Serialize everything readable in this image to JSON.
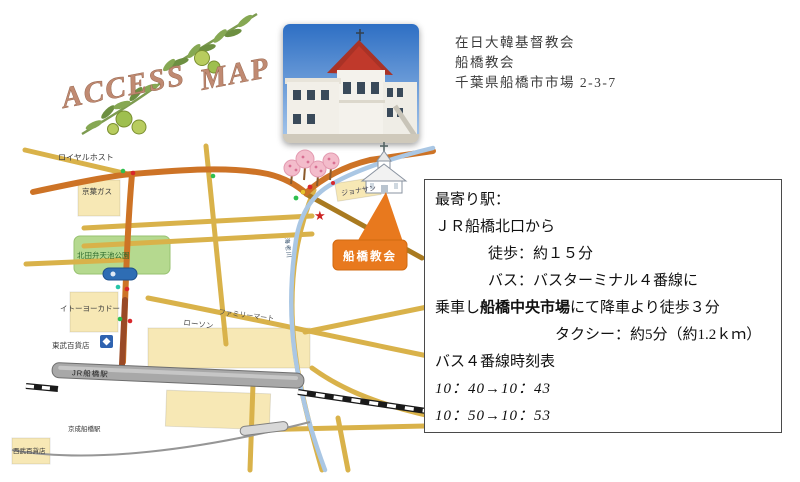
{
  "palette": {
    "road_main": "#cd7326",
    "road_minor": "#d9b24a",
    "road_dark": "#9a4a26",
    "river": "#aac7e4",
    "park_green": "#b5d98f",
    "building_yellow": "#f7e8b5",
    "callout_orange": "#e8791e",
    "rail_black": "#1a1a1a",
    "star_red": "#cc2222",
    "logo_text": "#c08a72",
    "olive_branch_green": "#7d9b50"
  },
  "logo": {
    "access": "ACCESS",
    "map": "MAP"
  },
  "header": {
    "line1": "在日大韓基督教会",
    "line2": "船橋教会",
    "line3": "千葉県船橋市市場 2-3-7"
  },
  "info_box": {
    "nearest_station_label": "最寄り駅：",
    "from_station": "ＪＲ船橋北口から",
    "walk": "徒歩：約１５分",
    "bus": "バス：バスターミナル４番線に",
    "bus_cont_pre": "乗車し",
    "bus_cont_bold": "船橋中央市場",
    "bus_cont_post": "にて降車より徒歩３分",
    "taxi": "タクシー：約5分（約1.2ｋｍ）",
    "timetable_title": "バス４番線時刻表",
    "timetable_row1": "10：40→10：43",
    "timetable_row2": "10：50→10：53"
  },
  "map": {
    "labels": {
      "royal_host": "ロイヤルホスト",
      "keiyo_gas": "京葉ガス",
      "park": "北田弁天池公園",
      "ito_yokado": "イトーヨーカドー",
      "tobu_dept": "東武百貨店",
      "seibu_dept": "西武百貨店",
      "lawson": "ローソン",
      "familymart": "ファミリーマート",
      "jonathan": "ジョナサン",
      "jr_station": "JR船橋駅",
      "keisei_station": "京成船橋駅",
      "river": "海老川",
      "callout": "船橋教会",
      "star": "★"
    }
  }
}
